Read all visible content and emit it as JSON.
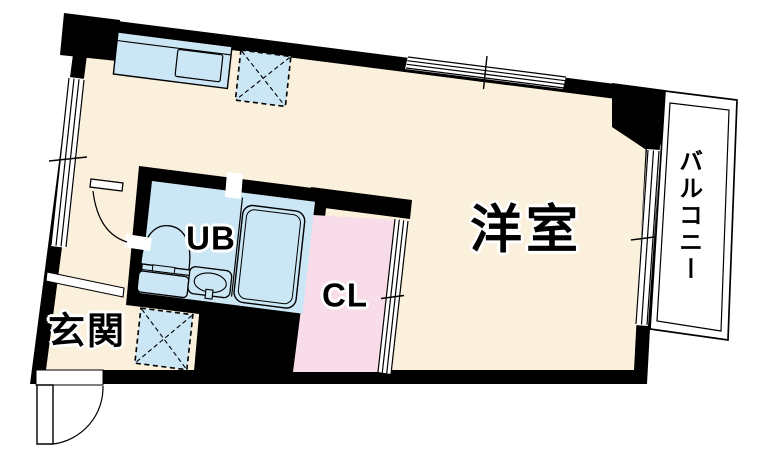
{
  "type": "apartment-floor-plan",
  "rooms": {
    "main": {
      "label": "洋室"
    },
    "unit_bath": {
      "label": "UB"
    },
    "closet": {
      "label": "CL"
    },
    "entrance": {
      "label": "玄関"
    },
    "balcony": {
      "label": "バルコニー"
    }
  },
  "colors": {
    "wall": "#000000",
    "floor": "#FBF0DB",
    "fixture_blue": "#CBE7F5",
    "closet_pink": "#F8DCE9",
    "balcony_white": "#FFFFFF",
    "line": "#000000"
  }
}
